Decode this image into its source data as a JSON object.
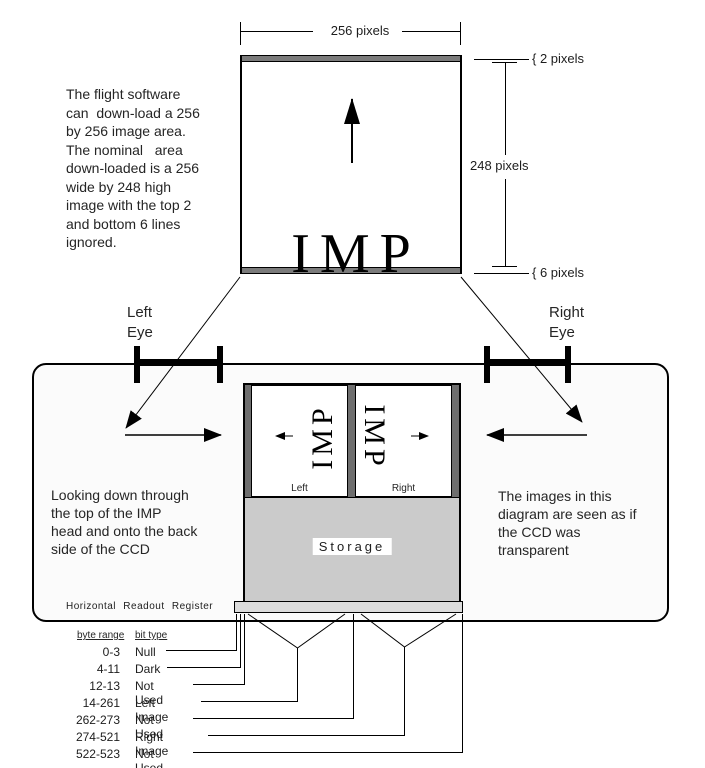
{
  "top_diagram": {
    "width_label": "256 pixels",
    "top_margin_label": "{ 2 pixels",
    "height_label": "248 pixels",
    "bottom_margin_label": "{ 6 pixels",
    "imp_label": "IMP"
  },
  "flight_note": "The flight software\ncan  down-load a 256\nby 256 image area.\nThe nominal   area\ndown-loaded is a 256\nwide by 248 high\nimage with the top 2\nand bottom 6 lines\nignored.",
  "left_eye_label": "Left\nEye",
  "right_eye_label": "Right\nEye",
  "ccd": {
    "left_imp": "IMP",
    "right_imp": "IMP",
    "left_label": "Left",
    "right_label": "Right",
    "storage_label": "Storage",
    "readout_label": "Horizontal Readout Register"
  },
  "panel_left_note": "Looking down through\nthe top of the IMP\nhead and onto the back\nside of the CCD",
  "panel_right_note": "The images in this\ndiagram are seen as if\nthe CCD was\ntransparent",
  "byte_table": {
    "headers": {
      "range": "byte range",
      "type": "bit type"
    },
    "rows": [
      {
        "range": "0-3",
        "type": "Null"
      },
      {
        "range": "4-11",
        "type": "Dark"
      },
      {
        "range": "12-13",
        "type": "Not Used"
      },
      {
        "range": "14-261",
        "type": "Left Image"
      },
      {
        "range": "262-273",
        "type": "Not Used"
      },
      {
        "range": "274-521",
        "type": "Right Image"
      },
      {
        "range": "522-523",
        "type": "Not Used"
      }
    ]
  },
  "colors": {
    "bar_gray": "#7b7b7b",
    "strip_gray": "#6e6e6e",
    "storage_gray": "#cbcbcb",
    "register_gray": "#dcdcdc",
    "panel_bg": "#fbfbfb",
    "line_black": "#000000"
  }
}
